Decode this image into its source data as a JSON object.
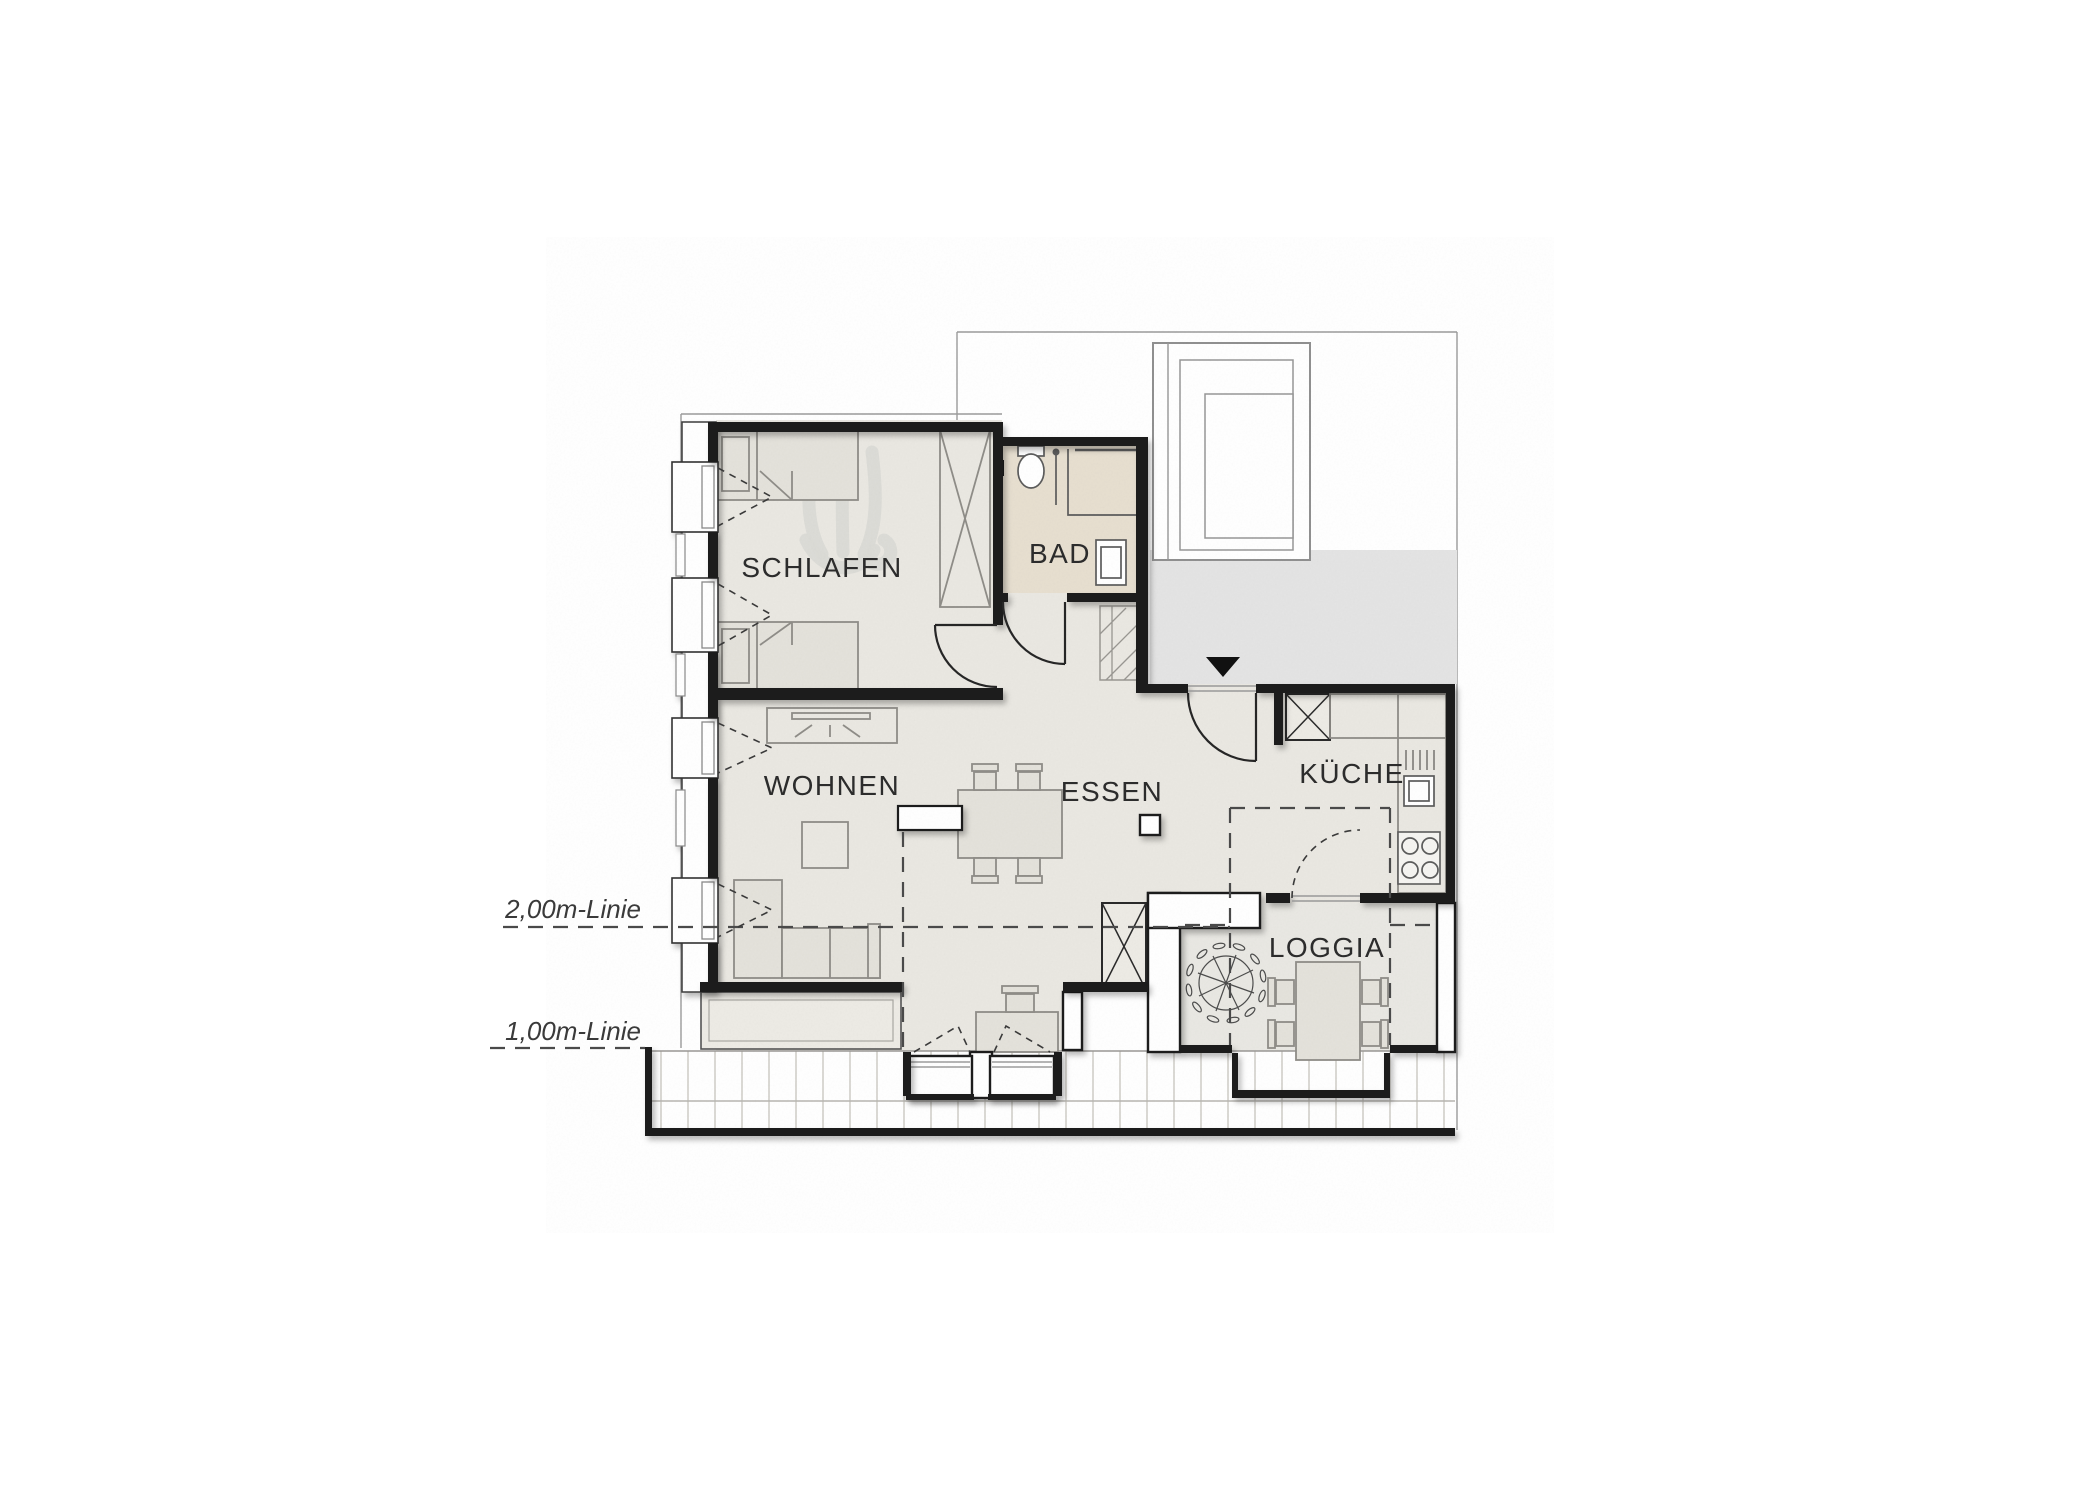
{
  "plan": {
    "kind": "apartment floor plan, attic storey with roof height lines",
    "labels": {
      "schlafen": "SCHLAFEN",
      "bad": "BAD",
      "wohnen": "WOHNEN",
      "essen": "ESSEN",
      "kueche": "KÜCHE",
      "loggia": "LOGGIA",
      "line_2m": "2,00m-Linie",
      "line_1m": "1,00m-Linie"
    },
    "icons": {
      "entrance_arrow": "filled black triangle pointing down at apartment entry",
      "tree": "plant sketch on loggia",
      "logo_watermark": "light grey brand watermark in bedroom"
    },
    "colors": {
      "wall": "#1d1d1d",
      "floor": "#eae8e2",
      "bath-floor": "#e7dfd0",
      "loggia-floor": "#e9e8e3",
      "landing": "#e4e4e4",
      "furniture": "#8f8d88",
      "furniture-fill": "#e4e2db"
    }
  }
}
